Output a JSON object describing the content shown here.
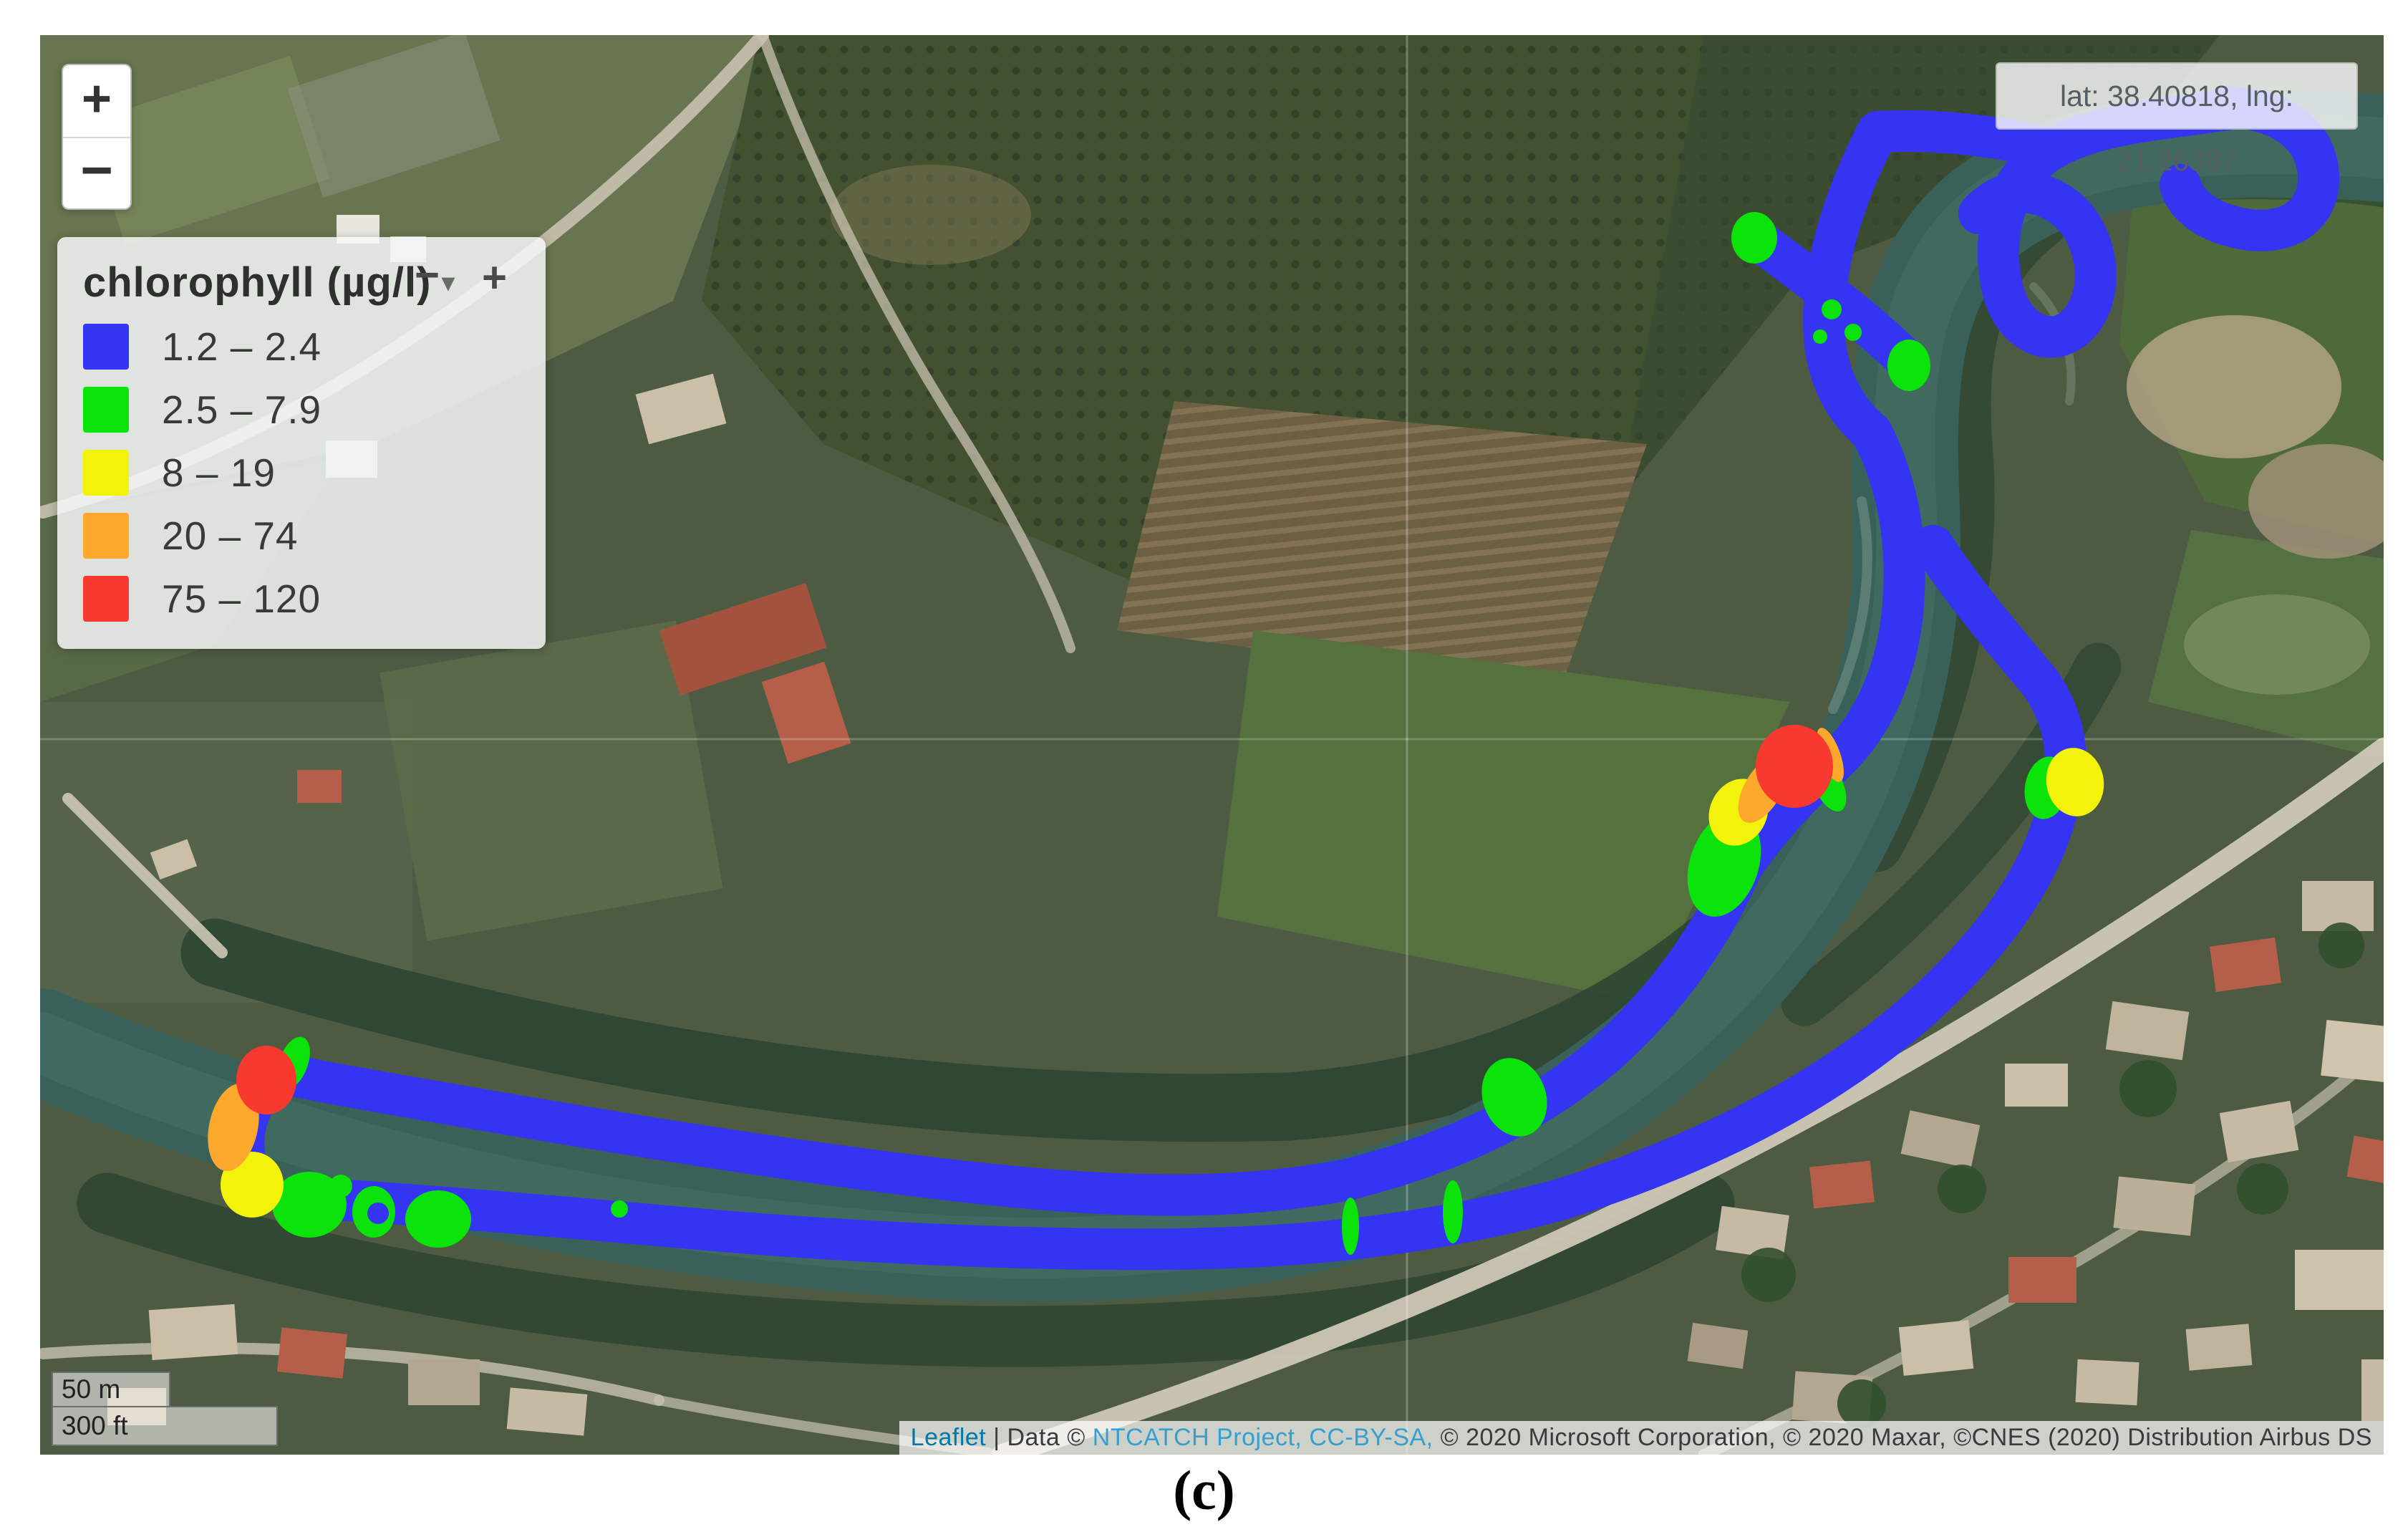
{
  "caption": "(c)",
  "map": {
    "controls": {
      "zoom_in": "+",
      "zoom_out": "−"
    },
    "coordinates_text": "lat: 38.40818, lng: 21.26387",
    "scale": {
      "metric": "50 m",
      "imperial": "300 ft"
    }
  },
  "legend": {
    "title": "chlorophyll (µg/l)",
    "collapse_caret": "▾",
    "minimize_label": "−",
    "maximize_label": "+",
    "items": [
      {
        "label": "1.2 – 2.4",
        "color": "#3434F2"
      },
      {
        "label": "2.5 – 7.9",
        "color": "#0BE30B"
      },
      {
        "label": "8 – 19",
        "color": "#F2F20A"
      },
      {
        "label": "20 – 74",
        "color": "#FCA82C"
      },
      {
        "label": "75 – 120",
        "color": "#F8392F"
      }
    ]
  },
  "attribution": {
    "parts": [
      {
        "text": "Leaflet",
        "color": "#0078A8",
        "name": "leaflet-link",
        "interactable": true
      },
      {
        "text": " | Data © ",
        "color": "#3b3b3b",
        "name": "attribution-text",
        "interactable": false
      },
      {
        "text": "NTCATCH Project, CC-BY-SA,",
        "color": "#35A0CE",
        "name": "ntcatch-link",
        "interactable": true
      },
      {
        "text": " © 2020 Microsoft Corporation, © 2020 Maxar, ©CNES (2020) Distribution Airbus DS",
        "color": "#3b3b3b",
        "name": "attribution-text",
        "interactable": false
      }
    ]
  }
}
